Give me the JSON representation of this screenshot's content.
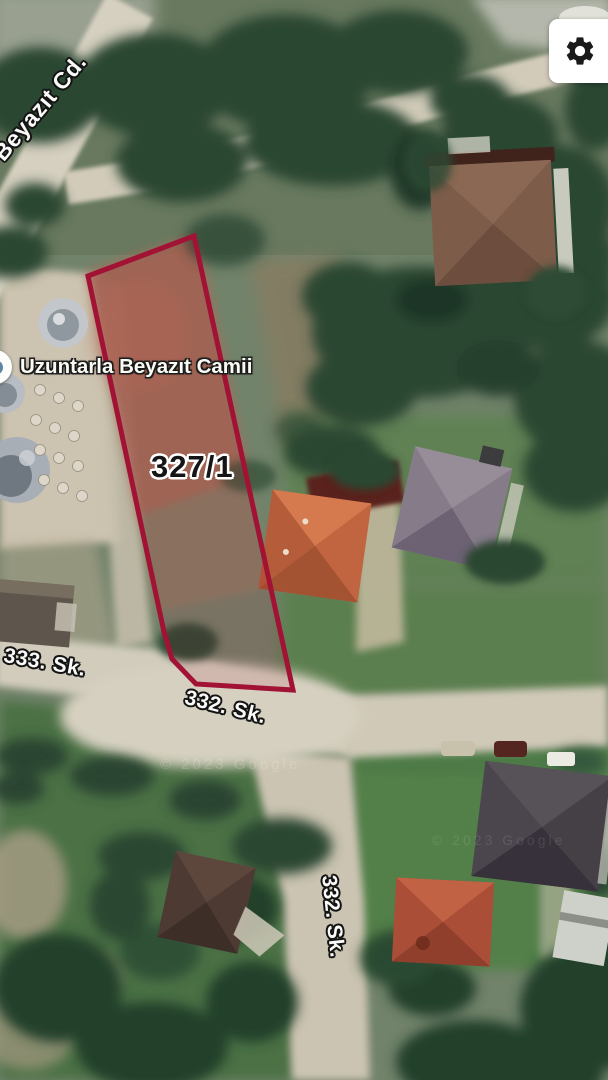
{
  "map": {
    "place_label": {
      "icon": "mosque-poi-icon",
      "text": "Uzuntarla Beyazıt Camii"
    },
    "parcel": {
      "label": "327/1",
      "outline_color": "#a11234"
    },
    "street_labels": {
      "beyazit_cd": "Beyazıt Cd.",
      "sk_333": "333. Sk.",
      "sk_332_mid": "332. Sk.",
      "sk_332_bottom": "332. Sk."
    },
    "watermark": "© 2023 Google"
  },
  "controls": {
    "settings": {
      "icon": "gear-icon"
    }
  }
}
